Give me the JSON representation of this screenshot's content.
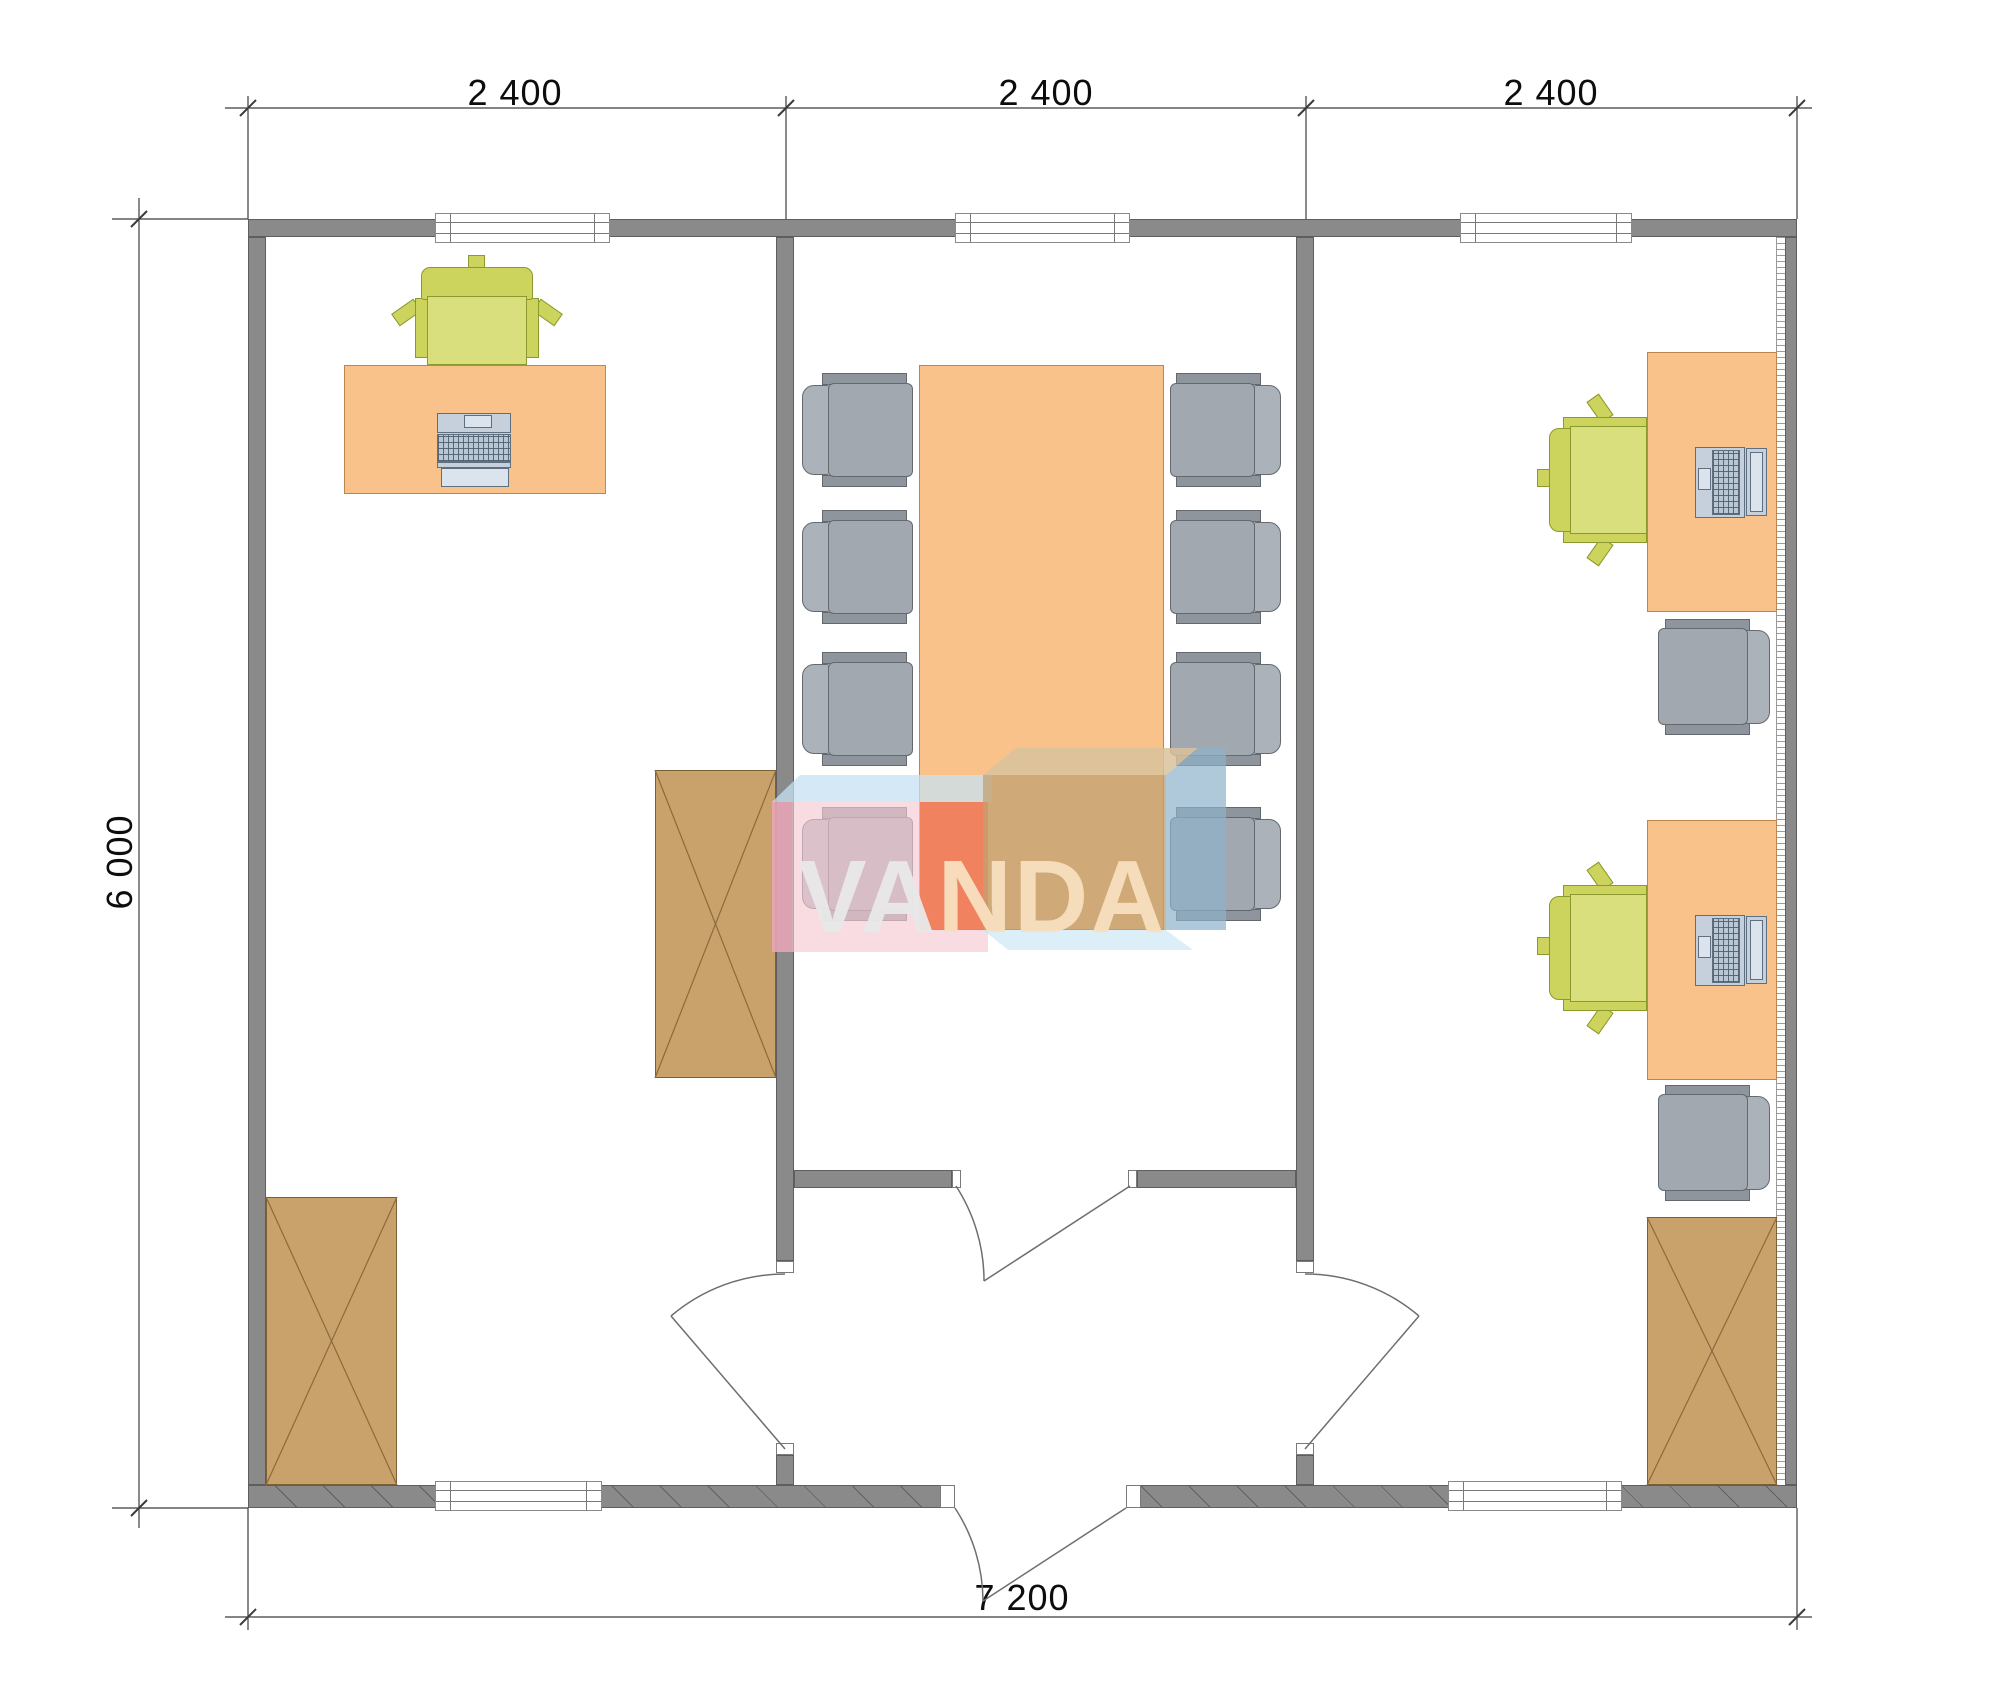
{
  "plan": {
    "dimensions": {
      "top": [
        "2 400",
        "2 400",
        "2 400"
      ],
      "left": "6 000",
      "bottom": "7 200"
    },
    "watermark": {
      "text": "VANDA",
      "part1": "VA",
      "part2": "NDA"
    },
    "colors": {
      "wall": "#8a8a8a",
      "wallEdge": "#5e5e5e",
      "desk": "#f9c28a",
      "deskEdge": "#bb874e",
      "green": "#d9df7c",
      "greenBack": "#ccd45e",
      "greenEdge": "#8a9a2e",
      "graySeat": "#a2a8af",
      "grayBack": "#acb2b9",
      "grayPlate": "#8f959c",
      "grayEdge": "#63696f",
      "cabinet": "#c9a26b",
      "cabinetEdge": "#7e5f35",
      "pc": "#c5d0dc",
      "pcEdge": "#5f6f80",
      "dimLine": "#3c3c3c",
      "wm_pink": "#f4c9d3",
      "wm_red": "#ee6b42",
      "wm_tan": "#c2a072",
      "wm_tanTop": "#d9c29b",
      "wm_blue": "#8fb2cb",
      "wm_lightblue": "#c5e2f2",
      "wm_textLight": "#e9e9e9",
      "wm_textCream": "#f8e0c0"
    }
  }
}
